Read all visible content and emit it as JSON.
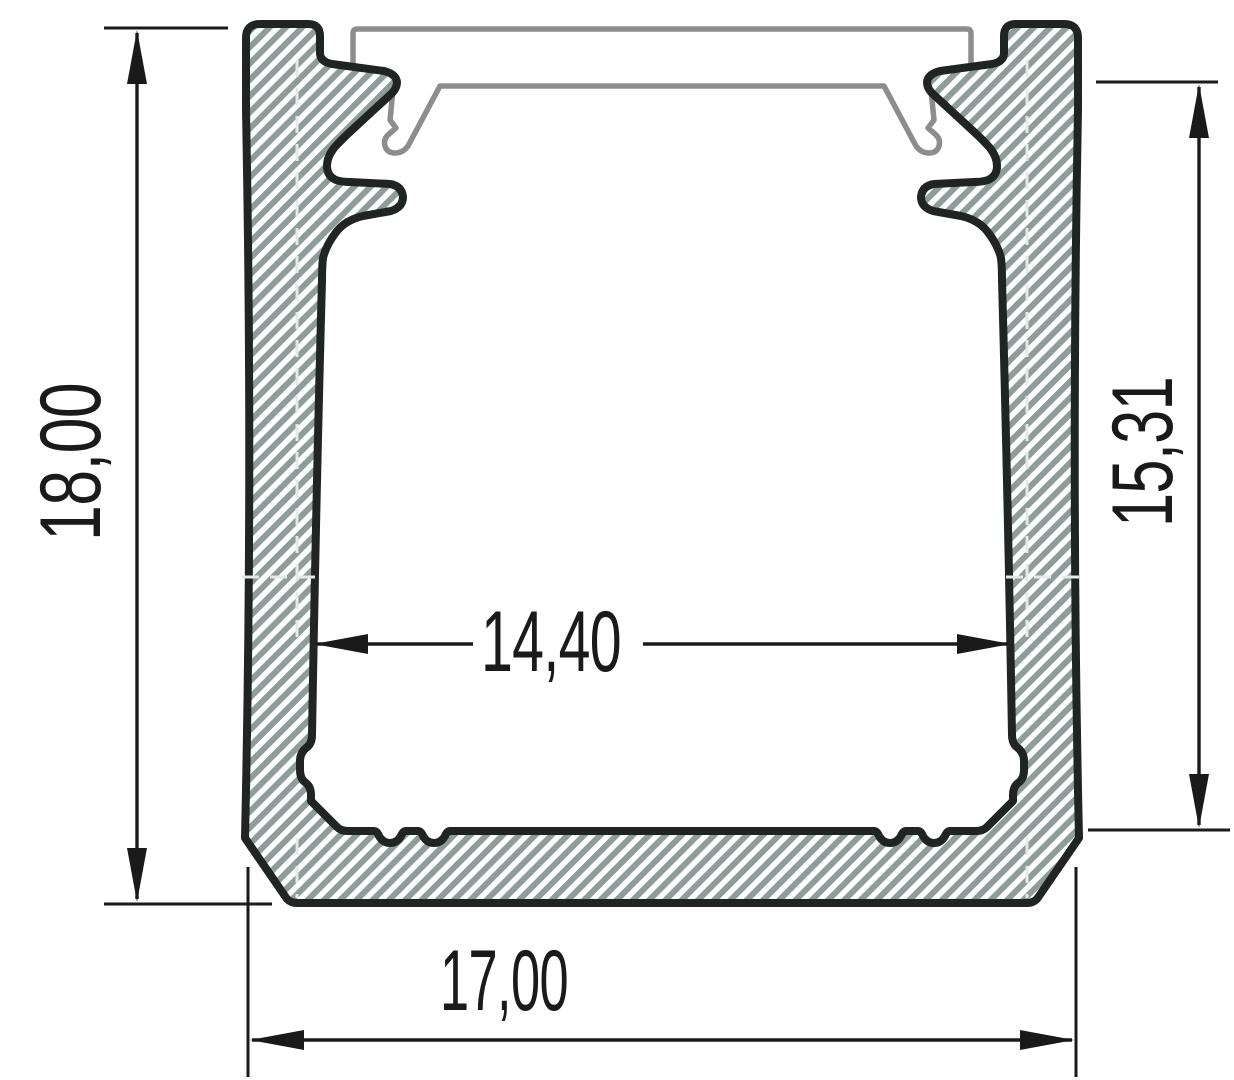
{
  "dimensions": {
    "overall_height": {
      "value": "18,00"
    },
    "inner_height": {
      "value": "15,31"
    },
    "inner_width": {
      "value": "14,40"
    },
    "overall_width": {
      "value": "17,00"
    }
  },
  "colors": {
    "background": "#ffffff",
    "hatch-stripe": "#8d9d99",
    "profile-outline": "#202523",
    "cover-outline": "#8d8d8d",
    "dimension-line": "#1a1a1a",
    "text": "#1a1a1a",
    "centerline": "#e3ebe8"
  }
}
